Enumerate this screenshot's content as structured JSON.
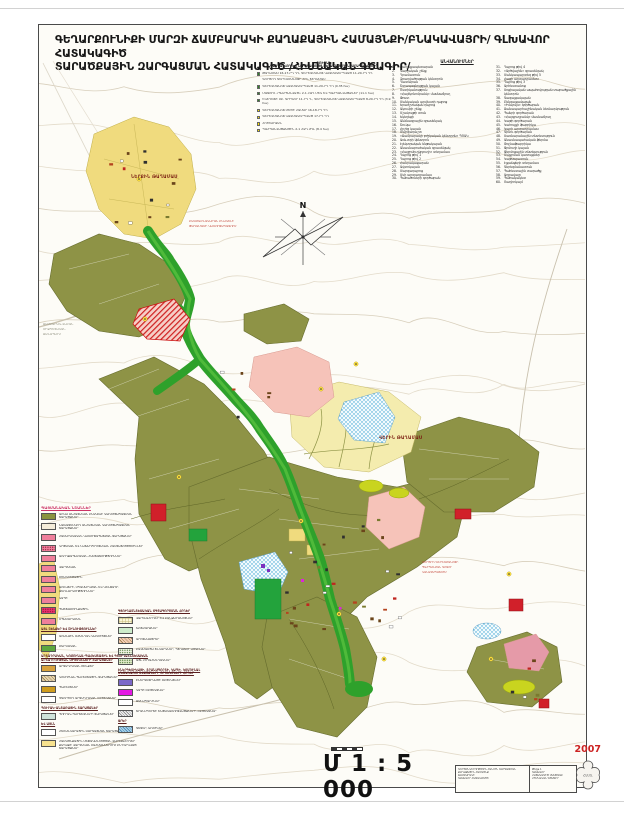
{
  "title": {
    "line1": "ԳԵՂԱՐՔՈՒՆԻՔԻ ՄԱՐԶԻ ՃԱՄԲԱՐԱԿԻ ՔԱՂԱՔԱՅԻՆ ՀԱՄԱՅՆՔԻ/ԲՆԱԿԱՎԱՅՐԻ/ ԳԼԽԱՎՈՐ ՀԱՏԱԿԱԳԻԾ",
    "line2": "ՏԱՐԱԾՔԱՅԻՆ ԶԱՐԳԱՑՄԱՆ ՀԱՏԱԿԱԳԻԾ /ՀԻՄՆԱԿԱՆ ԳԾԱԳԻՐ/"
  },
  "names_list": {
    "header": "ԱՆՎԱՆՈՒՄՆԵՐ",
    "col1": [
      {
        "num": "1.",
        "label": "Քաղաքապետարան"
      },
      {
        "num": "2.",
        "label": "Վարչական շենք"
      },
      {
        "num": "3.",
        "label": "Դրամատուն"
      },
      {
        "num": "4.",
        "label": "Զբաղվածության կենտրոն"
      },
      {
        "num": "5.",
        "label": "Դատարան"
      },
      {
        "num": "6.",
        "label": "Շտապօգնության կայան"
      },
      {
        "num": "7.",
        "label": "Ոստիկանություն"
      },
      {
        "num": "8.",
        "label": "«Հայէկոնոմբանկ» մասնաճյուղ"
      },
      {
        "num": "9.",
        "label": "Փոստ"
      },
      {
        "num": "10.",
        "label": "Մանկական արվեստի դպրոց"
      },
      {
        "num": "11.",
        "label": "Երաժշտական դպրոց"
      },
      {
        "num": "12.",
        "label": "Ակումբի շենք"
      },
      {
        "num": "13.",
        "label": "Մշակույթի տուն"
      },
      {
        "num": "14.",
        "label": "Եկեղեցի"
      },
      {
        "num": "15.",
        "label": "Անձնագրային գրասենյակ"
      },
      {
        "num": "16.",
        "label": "Շուկա"
      },
      {
        "num": "17.",
        "label": "Հրշեջ կայան"
      },
      {
        "num": "18.",
        "label": "Մարզադաշտ"
      },
      {
        "num": "19.",
        "label": "«Ճամբարակի բժշկական կենտրոն» ՊՈԱԿ"
      },
      {
        "num": "20.",
        "label": "Առևտրի կենտրոն"
      },
      {
        "num": "21.",
        "label": "Էլեկտրական ենթակայան"
      },
      {
        "num": "22.",
        "label": "Անասնաբուժական գրասենյակ"
      },
      {
        "num": "23.",
        "label": "«Հայջրմուղկոյուղի» տեղամաս"
      },
      {
        "num": "24.",
        "label": "Դպրոց թիվ 1"
      },
      {
        "num": "25.",
        "label": "Դպրոց թիվ 2"
      },
      {
        "num": "26.",
        "label": "Հանրակացարան"
      },
      {
        "num": "27.",
        "label": "Ավտոկայան"
      },
      {
        "num": "28.",
        "label": "Մարզադպրոց"
      },
      {
        "num": "29.",
        "label": "Մսի արտադրամաս"
      },
      {
        "num": "30.",
        "label": "Պահածոների գործարան"
      }
    ],
    "col2": [
      {
        "num": "31.",
        "label": "Դպրոց թիվ 4"
      },
      {
        "num": "32.",
        "label": "«Արծվաշեն» գրասենյակ"
      },
      {
        "num": "33.",
        "label": "Մանկապարտեզ թիվ 5"
      },
      {
        "num": "34.",
        "label": "Հացի արտադրամաս"
      },
      {
        "num": "35.",
        "label": "Դպրոց թիվ 3"
      },
      {
        "num": "36.",
        "label": "Արհեստանոց"
      },
      {
        "num": "37.",
        "label": "Սոցիալական ապահովության տարածքային կենտրոն"
      },
      {
        "num": "38.",
        "label": "Գազալցակայան"
      },
      {
        "num": "39.",
        "label": "Բենզալցակայան"
      },
      {
        "num": "40.",
        "label": "«Իմպուլս» գործարան"
      },
      {
        "num": "41.",
        "label": "Ճանապարհաշինական ձեռնարկություն"
      },
      {
        "num": "42.",
        "label": "Պանրի գործարան"
      },
      {
        "num": "43.",
        "label": "«Հայգյուղբանկ» մասնաճյուղ"
      },
      {
        "num": "44.",
        "label": "Կաթի գործարան"
      },
      {
        "num": "45.",
        "label": "Կահույքի ֆաբրիկա"
      },
      {
        "num": "46.",
        "label": "Կարի արտադրամաս"
      },
      {
        "num": "47.",
        "label": "Գինու գործարան"
      },
      {
        "num": "48.",
        "label": "Սառնարանային տնտեսություն"
      },
      {
        "num": "49.",
        "label": "Անասնապահական ֆերմա"
      },
      {
        "num": "50.",
        "label": "Թռչնաֆաբրիկա"
      },
      {
        "num": "51.",
        "label": "Ջրմուղի կայան"
      },
      {
        "num": "52.",
        "label": "Ջերմոցային տնտեսություն"
      },
      {
        "num": "53.",
        "label": "Մաքրման կառույցներ"
      },
      {
        "num": "54.",
        "label": "Կաթսայատուն"
      },
      {
        "num": "55.",
        "label": "Էլցանցերի տեղամաս"
      },
      {
        "num": "56.",
        "label": "Գերեզմանատուն"
      },
      {
        "num": "57.",
        "label": "Պահեստային տարածք"
      },
      {
        "num": "58.",
        "label": "Աղբավայր"
      },
      {
        "num": "59.",
        "label": "Պահակակետ"
      },
      {
        "num": "60.",
        "label": "Ռադիոկայմ"
      }
    ]
  },
  "protected_list": {
    "title": "ՑՈՒՑԱԿ",
    "subtitle": "ՊԱՀՊԱՆՎՈՂ ԵՎ ՆՈՐԱԿԱՌՈՒՅՑ ՏԵՂԱՄԱՍԵՐԻ ՆԿԱՐԱԳՐՈՒԹՅՈՒՆ",
    "items": [
      {
        "marker": "#2e8b22",
        "label": "ԹԱՂԱՄԱՍ 16-17-ՐԴ ԴԴ, ԳԵՐԵԶՄԱՆՈՑ ԿԱԶՄԱԿԵՐՊՎԱԾ 11-20-ՐԴ ԴԴ"
      },
      {
        "marker": "none",
        "label": "ԳՈՐԾՈՂ ԳԵՐԵԶՄԱՆՈՑԻ ՀԻՆ ՏԵՂԱՄԱՍ"
      },
      {
        "marker": "#2e8b22",
        "label": "ԳԵՐԵԶՄԱՆՈՑ ԿԱԶՄԱԿԵՐՊՎԱԾ 11-20-ՐԴ ԴԴ  (0.35 հա)"
      },
      {
        "marker": "#2e8b22",
        "label": "ՄԱՏՈՒՌ «ՊԱՀՊԱՆՎԱԾ» 2-1 ՀՁԴ ՄԵԿ ԵՎ ՊԱՀՊԱՆՎԱԾՔՆԵՐ (11.1 հա)"
      },
      {
        "marker": "#2e8b22",
        "label": "ԵԿԵՂԵՑԻ ՍԲ. ԳՐԻԳՈՐ 11-ՐԴ Դ., ԳԵՐԵԶՄԱՆՈՑ ԿԱԶՄԱԿԵՐՊՎԱԾ 8-20-ՐԴ ԴԴ (3.9 հա)"
      },
      {
        "marker": "#ffe400",
        "label": "ԳԵՐԵԶՄԱՆՈՑ ՄԵԾԻ ՀԱՄԱՐ 16-18-ՐԴ ԴԴ"
      },
      {
        "marker": "#ffe400",
        "label": "ԳԵՐԵԶՄԱՆՈՑ ԿԱԶՄԱԿԵՐՊՎԱԾ 17-ՐԴ ԴԴ"
      },
      {
        "marker": "#ffe400",
        "label": "ՀՈՒՇԱՐՁԱՆ"
      },
      {
        "marker": "#ffe400",
        "label": "ՊԱՀՊԱՆՎԱԾՔԱՅԻՆ 2-1 ՀՁԴ ԺԴԼ  (8.4 հա)"
      }
    ]
  },
  "legend_left": {
    "blocks": [
      {
        "h": "ՊԱՅՄԱՆԱԿԱՆ ՆՇԱՆՆԵՐ",
        "red": true
      },
      {
        "c": "#8a9440",
        "t": "ԱՌԿԱ ԱՆՀԱՏԱԿԱՆ ԲՆԱԿԵԼԻ ԿԱՌՈՒՑԱՊԱՏՄԱՆ ՏԱՐԱԾՔՆԵՐ"
      },
      {
        "c": "#f4ecd9",
        "t": "ՆԱԽԱՏԵՍՎՈՂ ԱՆՀԱՏԱԿԱՆ ԿԱՌՈՒՑԱՊԱՏՄԱՆ ՏԱՐԱԾՔՆԵՐ"
      },
      {
        "c": "#ef7f9b",
        "t": "ՀԱՍԱՐԱԿԱԿԱՆ ԿԱՌՈՒՑԱՊԱՏՄԱՆ ՏԱՐԱԾՔՆԵՐ"
      },
      {
        "c": "#ef7f9b",
        "p": "p-dots",
        "t": "ԿՐԹԱԿԱՆ ԵՎ ՆԱԽԱԴՊՐՈՑԱԿԱՆ ՀԱՍՏԱՏՈՒԹՅՈՒՆՆԵՐ"
      },
      {
        "c": "#ef7f9b",
        "t": "ԱՌՈՂՋԱՊԱՀԱԿԱՆ ՀԱՍՏԱՏՈՒԹՅՈՒՆՆԵՐ"
      },
      {
        "c": "#ef7f9b",
        "t": "ՎԱՐՉԱԿԱՆ"
      },
      {
        "c": "#ef7f9b",
        "t": "ՄՇԱԿՈՒԹԱՅԻՆ"
      },
      {
        "c": "#ef7f9b",
        "t": "ԱՌԵՎՏՐԻ, ՍՊԱՍԱՐԿՄԱՆ ԵՎ ԿԵՆՑԱՂԻ ՁԵՌՆԱՐԿՈՒԹՅՈՒՆՆԵՐ"
      },
      {
        "c": "#ef7f9b",
        "t": "ԿԱՊԻ"
      },
      {
        "c": "#e8336e",
        "p": "p-dots",
        "t": "ՊԱՇՏԱՄՈՒՆՔԱՅԻՆ"
      },
      {
        "c": "#ef7f9b",
        "t": "ՍՊԱՍԱՐԿՄԱՆ"
      },
      {
        "h": "ԱՅԼ ՇԵՆՔԵՐ ԵՎ ՇԻՆՈՒԹՅՈՒՆՆԵՐ"
      },
      {
        "c": "#ffffff",
        "t": "ԱՌԱՆՁԻՆ ՕԺԱՆԴԱԿ ԿԱՌՈՒՅՑՆԵՐ"
      },
      {
        "c": "#5da83e",
        "t": "ՄԱՐԶԱԿԱՆ"
      },
      {
        "h": "ԱՐՏԱԴՐԱԿԱՆ, ԿՈՄՈՒՆԱԼ-ՊԱՀԵՍՏԱՅԻՆ ԵՎ ԳՅՈՒՂԱՏՆՏԵՍԱԿԱՆ ԱՐՏԱԴՐՈՒԹՅԱՆ ՕԲՅԵԿՏՆԵՐԻ ՏԱՐԱԾՔՆԵՐ"
      },
      {
        "c": "#d9a23c",
        "t": "ԱՐՏԱԴՐԱԿԱՆ ՇԵՆՔԵՐ"
      },
      {
        "c": "#e5d3ae",
        "p": "p-hatch",
        "t": "ԿՈՄՈՒՆԱԼ-ՊԱՀԵՍՏԱՅԻՆ ՏԱՐԱԾՔՆԵՐ"
      },
      {
        "c": "#cf9c1d",
        "t": "ՊԱՀԵՍՏՆԵՐ"
      },
      {
        "c": "#ffffff",
        "t": "ՉԳՈՐԾՈՂ ԱՐՏԱԴՐԱԿԱՆ ՕԲՅԵԿՏՆԵՐ"
      },
      {
        "h": "ՊՈՒՐԱԿ-ԱՆՏԱՌԱՅԻՆ ՏԱՐԱԾՔՆԵՐ"
      },
      {
        "c": "#cfe3da",
        "t": "ՊՈՒՐԱԿ-ՊԱՐՏԵԶՆԵՐԻ ՏԱՐԱԾՔՆԵՐ"
      },
      {
        "h": "ԵՎ ԱՅԼՆ"
      },
      {
        "c": "#ffffff",
        "t": "ՀԵՌԱՆԿԱՐԱՅԻՆ ԶԱՐԳԱՑՄԱՆ ՏԱՐԱԾՔ"
      },
      {
        "c": "#f7e28f",
        "t": "ՀԱՄԱՅՆՔԱՅԻՆ ՍԵՓԱԿԱՆՈՒԹՅԱՆ ՎԱՐԵԼԱՀՈՂԵՐ ՔԱՂԱՔԻ ՎԱՐՉԱԿԱՆ ՍԱՀՄԱՆՆԵՐՈՒՄ ԸՆԴԳՐԿՎԱԾ ՏԱՐԱԾՔՆԵՐ"
      }
    ]
  },
  "legend_mid": {
    "blocks": [
      {
        "h": "ԳՅՈՒՂԱՏՆՏԵՍԱԿԱՆ ՕԳՏԱԳՈՐԾՄԱՆ ՀՈՂԵՐ"
      },
      {
        "c": "#faf6d8",
        "p": "p-grid",
        "t": "ՎԱՐԵԼԱՀՈՂԵՐ ԵՎ ԲԱՆՋԱՐԱՆՈՑՆԵՐ"
      },
      {
        "c": "#cdeccb",
        "t": "ԽՈՏՀԱՐՔՆԵՐ"
      },
      {
        "c": "#f3cdb4",
        "p": "p-hatch",
        "t": "ԱՐՈՏԱՎԱՅՐԵՐ"
      },
      {
        "c": "#eef3e2",
        "p": "p-gdots",
        "t": "ԲԱԶՄԱՄՅԱ ՏՆԿԱՐԿՆԵՐ, ՊՏՂԱՏՈՒ ԱՅԳԻՆԵՐ"
      },
      {
        "c": "#dfe9c8",
        "p": "p-gdots",
        "t": "ԱՅԼ ՀՈՂԱՀԱՆԴԱԿՆԵՐ"
      },
      {
        "h": "ԷՆԵՐԳԵՏԻԿԱՅԻ, ՏՐԱՆՍՊՈՐՏԻ, ԿԱՊԻ, ԿՈՄՈՒՆԱԼ ԵՆԹԱԿԱՌՈՒՑՎԱԾՔՆԵՐԻ ՕԲՅԵԿՏՆԵՐԻ ՀՈՂԵՐ"
      },
      {
        "c": "#7b68c8",
        "t": "ԷՆԵՐԳԵՏԻԿԱՅԻ ՕԲՅԵԿՏՆԵՐ"
      },
      {
        "c": "#e318e3",
        "t": "ԿԱՊԻ ՕԲՅԵԿՏՆԵՐ"
      },
      {
        "c": "#ffffff",
        "t": "ՃԱՆԱՊԱՐՀՆԵՐ"
      },
      {
        "c": "#efefef",
        "p": "p-ghatch",
        "t": "ՏՐԱՆՍՊՈՐՏԻ ԵՆԹԱԿԱՌՈՒՑՎԱԾՔՆԵՐԻ ՕԲՅԵԿՏՆԵՐ"
      },
      {
        "h": "ՋՐԵՐ"
      },
      {
        "c": "#a9d4ea",
        "p": "p-bhatch",
        "t": "ԳԵՏԵՐ, ԱՌՈՒՆԵՐ"
      }
    ]
  },
  "map_labels": {
    "lower_quarter": "ՆԵՐՔԻՆ ԹԱՂԱՄԱՍ",
    "upper_quarter": "ՎԵՐԻՆ ԹԱՂԱՄԱՍ",
    "district": [
      "ԲԱԶՄԱԲՆԱԿԱՐԱՆ ԲՆԱԿԵԼԻ",
      "ԹԱՂԱՄԱՍԻ ԿԱՌՈՒՑԱՊԱՏՈՒՄ"
    ],
    "road": [
      "ՃԱՄԲԱՐԱԿ-ՎԱՀԱՆ",
      "ՄԻՋՊԵՏԱԿԱՆ",
      "ՃԱՆԱՊԱՐՀ"
    ],
    "cemetery": [
      "ԳՈՐԾՈՂ ԳԵՐԵԶՄԱՆՈՑԻ",
      "ՊԱՀՊԱՆՄԱՆ ԳՈՏՈՒ",
      "ԿԱՆԱՉԱՊԱՏՈՒՄ"
    ]
  },
  "compass": {
    "north": "N"
  },
  "scale": {
    "text": "Մ 1 : 5 000"
  },
  "title_block": {
    "left_lines": [
      "ԳՈՐԾԸՆԿԵՐՈՒԹՅՈՒՆ ՀԱՆՈՒՆ ԶԱՐԳԱՑՄԱՆ",
      "ՔԱՂԱՔԱՅԻՆ ՀԱՄԱՅՆՔ",
      "ՃԱՄԲԱՐԱԿԻ",
      "ԳԼԽԱՎՈՐ ՀԱՏԱԿԱԳԻԾ"
    ],
    "right_lines": [
      "Թերթ 1",
      "ԳԼԽԱՎՈՐ",
      "ՀԱՏԱԿԱԳԻԾ ՄԱՍՇՏԱԲ",
      "ՀԻՄՆԱԿԱՆ ԳԾԱԳԻՐ"
    ]
  },
  "stamp": {
    "year": "2007",
    "seal_text": "ՀԱՍՏ."
  }
}
